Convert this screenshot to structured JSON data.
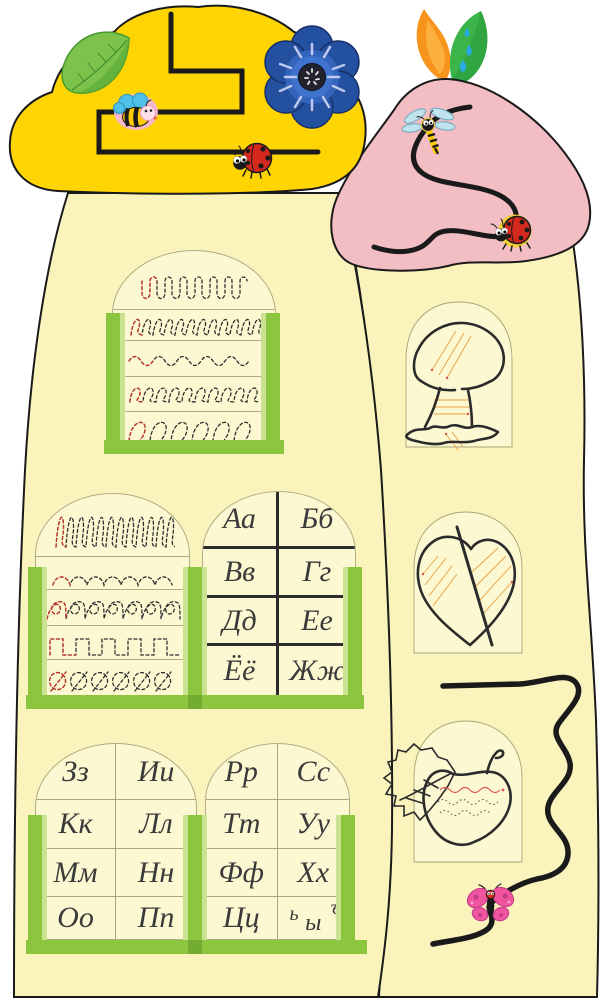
{
  "palette": {
    "background": "#FFFFFF",
    "cap_yellow": "#FFD403",
    "cap_pink": "#F3BDC4",
    "body_cream": "#FAF3BC",
    "window_cream": "#FCF8D2",
    "frame_green": "#8CC63F",
    "frame_green_light": "#CBE293",
    "frame_green_dark": "#72AC31",
    "outline_black": "#1A1A1A",
    "ink": "#3A3A3A",
    "trace_dark": "#2F2F2F",
    "trace_red": "#C7342A",
    "flower_blue": "#2450A0",
    "ladybug_red": "#D6291E",
    "butterfly_pink": "#F0549E"
  },
  "alphabet": {
    "w1": [
      "Аа",
      "Бб",
      "Вв",
      "Гг",
      "Дд",
      "Ее",
      "Ёё",
      "Жж"
    ],
    "w2": [
      "Зз",
      "Ии",
      "Кк",
      "Лл",
      "Мм",
      "Нн",
      "Оо",
      "Пп"
    ],
    "w3": [
      "Рр",
      "Сс",
      "Тт",
      "Уу",
      "Фф",
      "Хх",
      "Цц"
    ],
    "signs": {
      "soft": "ь",
      "hard": "ъ",
      "yery": "ы"
    }
  },
  "tracing": {
    "top_window_rows": [
      "deep-scallops",
      "small-loops",
      "waves",
      "round-loops",
      "big-loops"
    ],
    "middle_window_rows": [
      "tall-loops",
      "arches",
      "figure-eights",
      "square-wave",
      "slashed-circles"
    ]
  },
  "pictures": [
    "mushroom",
    "leaf",
    "apple"
  ],
  "decorations": {
    "big_cap": [
      "green-leaf",
      "blue-flower",
      "bee",
      "ladybug",
      "zigzag-trace-path"
    ],
    "small_cap": [
      "autumn-leaves",
      "water-drops",
      "dragonfly",
      "ladybug",
      "curvy-trace-path"
    ],
    "right_column": [
      "wavy-trace-path",
      "butterfly"
    ]
  }
}
